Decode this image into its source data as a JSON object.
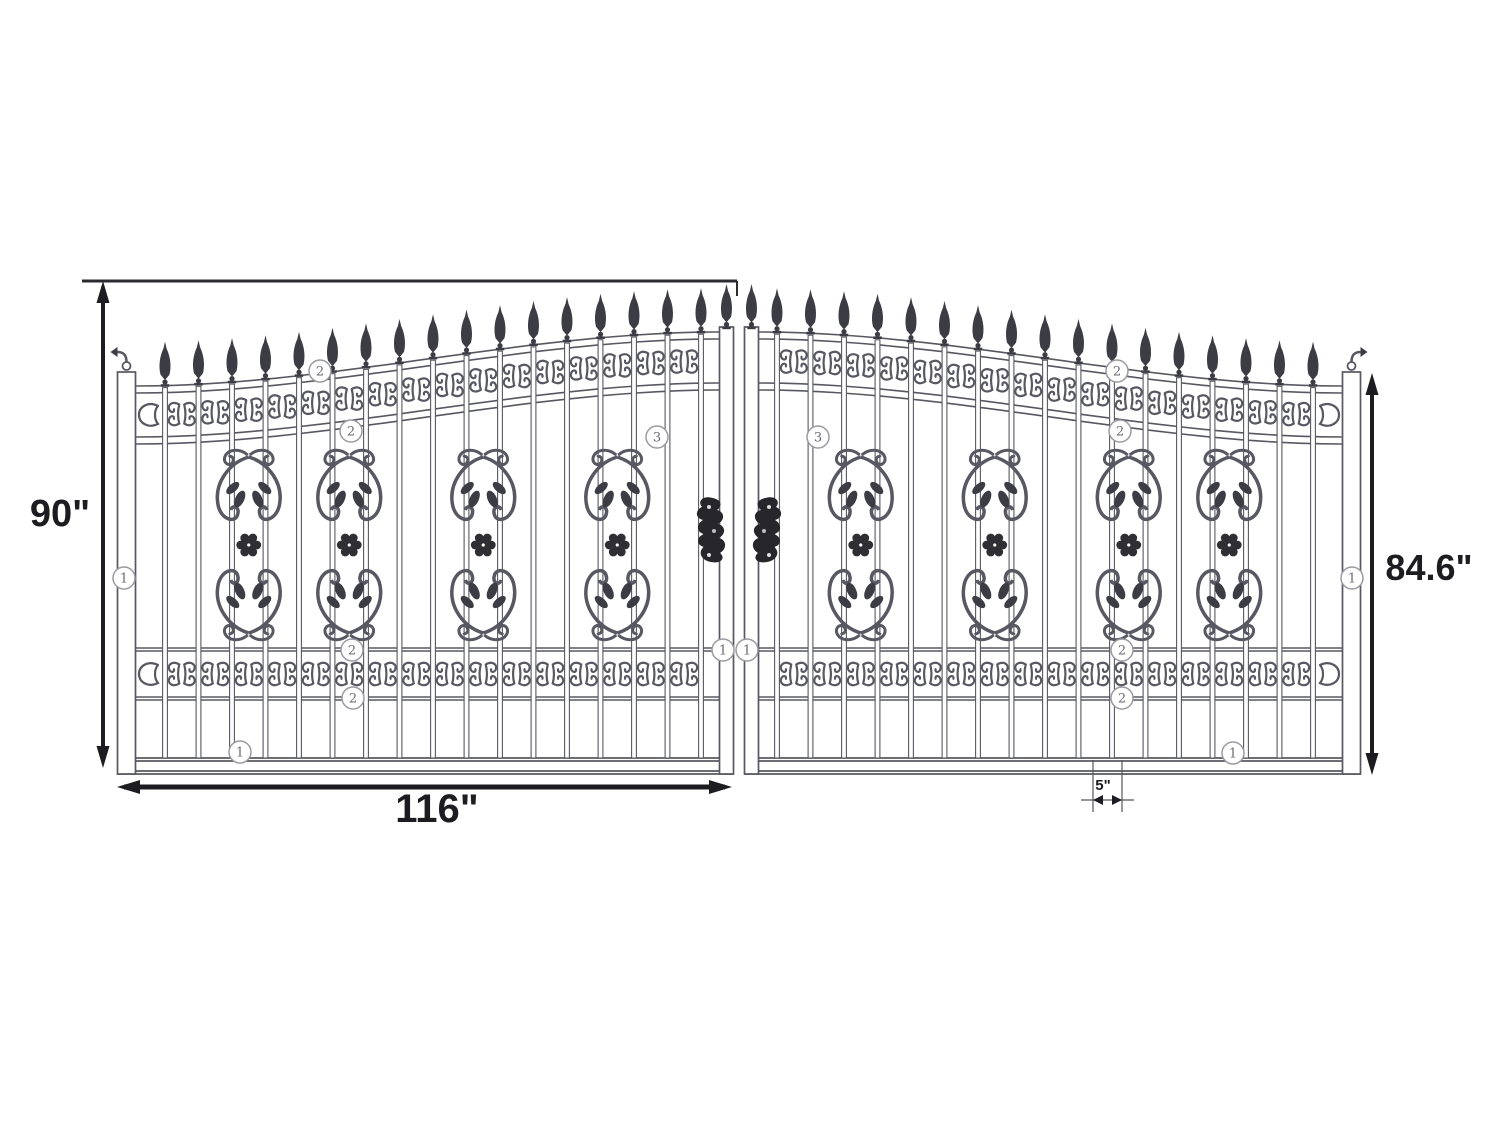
{
  "drawing": {
    "title": "dual-swing-ornamental-iron-gate-technical-drawing",
    "dimensions": {
      "overall_height": "90\"",
      "leaf_outer_height": "84.6\"",
      "leaf_width": "116\"",
      "picket_spacing": "5\""
    },
    "markers": {
      "part1": "1",
      "part2": "2",
      "part3": "3"
    },
    "colors": {
      "line": "#585862",
      "ornament_fill": "#3c3c44",
      "latch_fill": "#26262b",
      "dimension": "#1d1d21",
      "background": "#ffffff"
    }
  }
}
